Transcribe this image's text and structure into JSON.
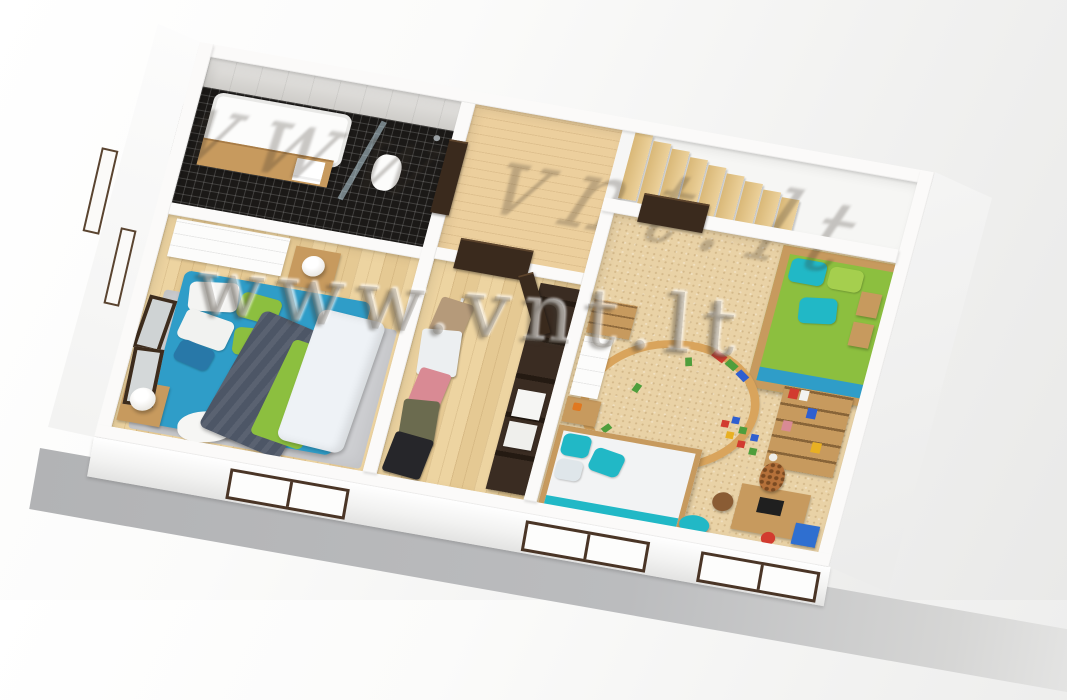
{
  "watermark": {
    "text": "www.vnt.lt"
  },
  "scene": {
    "description": "3D cutaway bird's-eye render of an upper-floor apartment plan",
    "stairs": {
      "steps": 9
    },
    "rooms": [
      {
        "name": "bathroom",
        "furniture": [
          "bathtub",
          "wood-vanity-shelf",
          "towels",
          "toilet",
          "glass-shower"
        ]
      },
      {
        "name": "landing",
        "furniture": [
          "staircase"
        ]
      },
      {
        "name": "master-bedroom",
        "furniture": [
          "double-bed",
          "dresser",
          "nightstands",
          "table-lamps",
          "armchair",
          "rug",
          "leaning-mirrors"
        ]
      },
      {
        "name": "walk-in-closet",
        "furniture": [
          "clothes-rack",
          "shelving-unit",
          "storage-boxes"
        ]
      },
      {
        "name": "kids-room",
        "furniture": [
          "green-daybed",
          "single-bed",
          "bookshelf",
          "wall-shelves",
          "toy-train-track",
          "toy-blocks",
          "toy-giraffe",
          "desk",
          "beanbag",
          "toy-bin"
        ]
      }
    ]
  },
  "palette": {
    "wall": "#fbfaf9",
    "slab": "#b5b6b8",
    "woodFloor": "#ecd19b",
    "woodFloorDark": "#d9b878",
    "landingWood": "#eccf9d",
    "carpet": "#e9d2a6",
    "tileWall": "#d9d7d3",
    "mosaic": "#1b1917",
    "woodFurn": "#c79a5e",
    "teal": "#2f9dc8",
    "turquoise": "#21b8c6",
    "green": "#8cbf3f",
    "blanket": "#4d5666",
    "duvet": "#eef2f6",
    "rug": "#cdced1",
    "door": "#3a2a1d",
    "pink": "#d98a94",
    "olive": "#6b6b4f",
    "coatBlack": "#26262a",
    "blockRed": "#d23b2f",
    "blockBlue": "#2f5fd0",
    "blockGreen": "#4f9e3c",
    "blockYellow": "#e8b023",
    "toyBin": "#2f6fd0",
    "giraffe": "#b5713a"
  }
}
